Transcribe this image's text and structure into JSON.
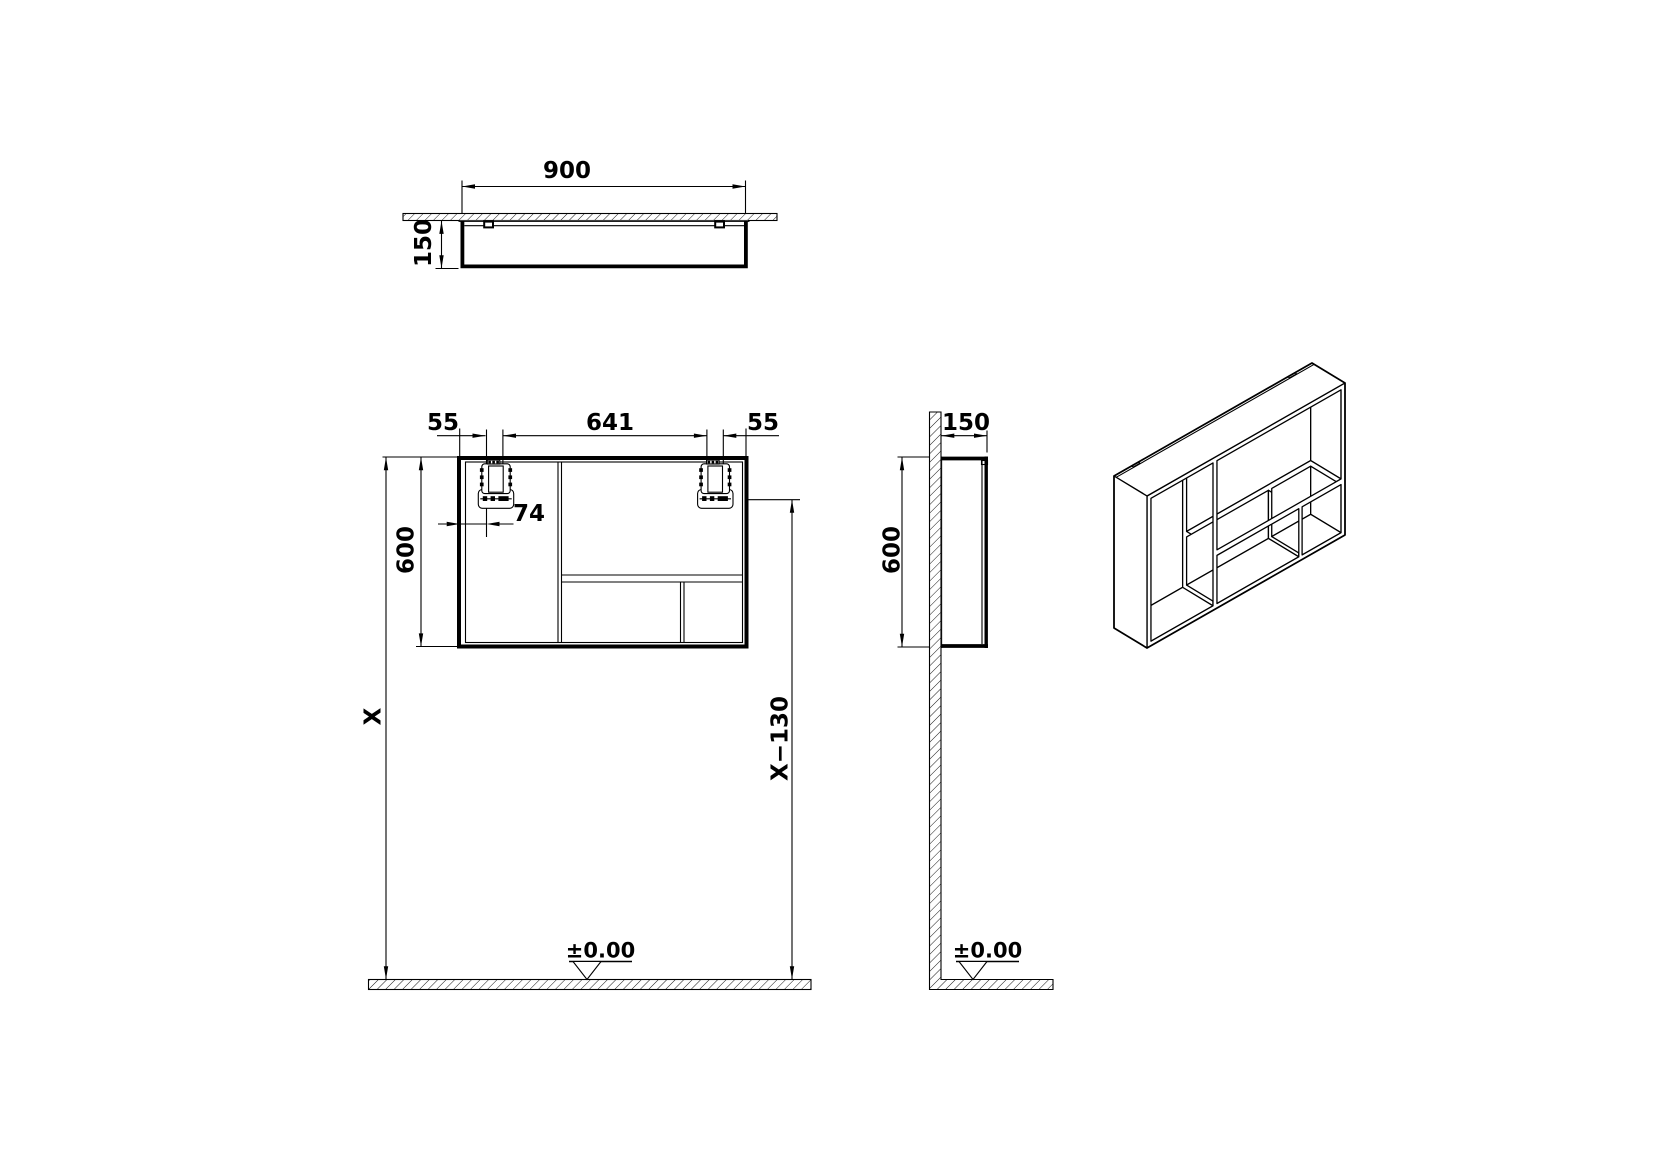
{
  "page": {
    "background": "#ffffff",
    "line_color": "#000000"
  },
  "top_view": {
    "width_label": "900",
    "depth_label": "150"
  },
  "front_view": {
    "left_offset_label": "55",
    "hanger_span_label": "641",
    "right_offset_label": "55",
    "hanger_inset_label": "74",
    "height_label": "600",
    "mount_height_label": "X",
    "hanger_height_label": "X−130",
    "floor_datum_label": "±0.00"
  },
  "side_view": {
    "depth_label": "150",
    "height_label": "600",
    "floor_datum_label": "±0.00"
  },
  "iso_model": {
    "width_mm": 900,
    "height_mm": 600,
    "depth_mm": 150,
    "panel_mm": 18,
    "divider_at_mm": 300,
    "shelf_top_mm": 370,
    "shelf_bottom_mm": 392,
    "small_divider_mm": [
      690,
      705
    ],
    "back_inset_mm": 12,
    "notches_mm": [
      [
        80,
        110
      ],
      [
        790,
        822
      ]
    ]
  }
}
